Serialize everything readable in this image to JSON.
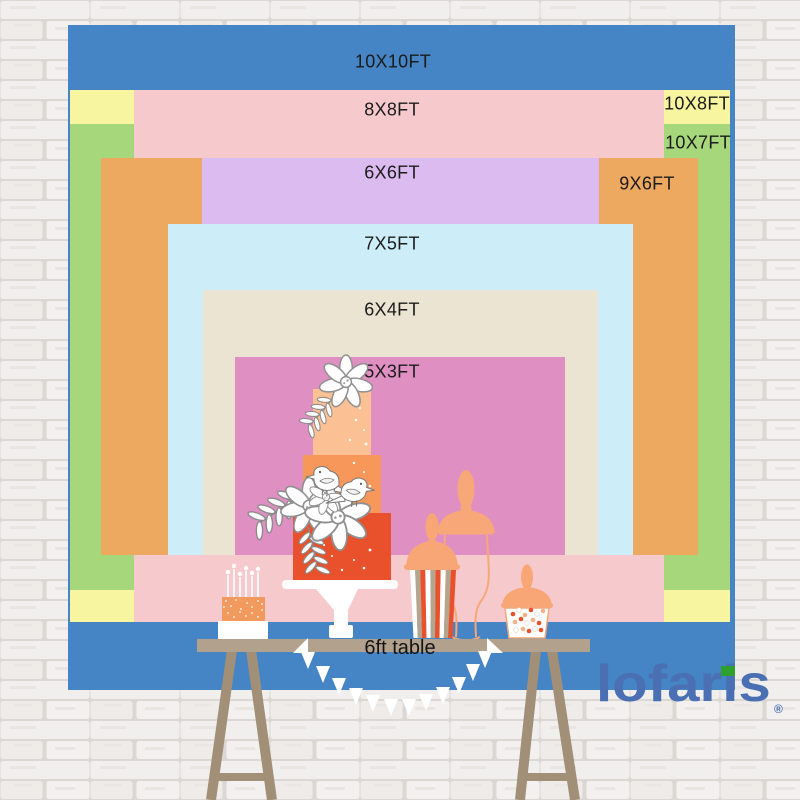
{
  "page": {
    "title": "Backdrop size comparison chart"
  },
  "sizes": [
    {
      "id": "10x10",
      "label": "10X10FT",
      "color": "#4584c5",
      "x": 68,
      "y": 25,
      "w": 667,
      "h": 665,
      "label_x": 393,
      "label_y": 62
    },
    {
      "id": "10x8",
      "label": "10X8FT",
      "color": "#f8f5a1",
      "x": 70,
      "y": 90,
      "w": 660,
      "h": 532,
      "label_x": 697,
      "label_y": 104
    },
    {
      "id": "10x7",
      "label": "10X7FT",
      "color": "#a7d77b",
      "x": 70,
      "y": 124,
      "w": 660,
      "h": 466,
      "label_x": 698,
      "label_y": 143
    },
    {
      "id": "8x8",
      "label": "8X8FT",
      "color": "#f6c9cd",
      "x": 134,
      "y": 90,
      "w": 530,
      "h": 532,
      "label_x": 392,
      "label_y": 110
    },
    {
      "id": "9x6",
      "label": "9X6FT",
      "color": "#eda960",
      "x": 101,
      "y": 158,
      "w": 597,
      "h": 397,
      "label_x": 647,
      "label_y": 184
    },
    {
      "id": "6x6",
      "label": "6X6FT",
      "color": "#dcbcf0",
      "x": 202,
      "y": 158,
      "w": 397,
      "h": 397,
      "label_x": 392,
      "label_y": 173
    },
    {
      "id": "7x5",
      "label": "7X5FT",
      "color": "#cdeef9",
      "x": 168,
      "y": 224,
      "w": 465,
      "h": 331,
      "label_x": 392,
      "label_y": 244
    },
    {
      "id": "6x4",
      "label": "6X4FT",
      "color": "#ece4d2",
      "x": 203,
      "y": 290,
      "w": 395,
      "h": 265,
      "label_x": 392,
      "label_y": 310
    },
    {
      "id": "5x3",
      "label": "5X3FT",
      "color": "#e08fc3",
      "x": 235,
      "y": 357,
      "w": 330,
      "h": 198,
      "label_x": 392,
      "label_y": 372
    }
  ],
  "table": {
    "label": "6ft table"
  },
  "brand": {
    "name": "lofaris",
    "registered": "®",
    "blue": "#4a6fb3",
    "green": "#2ea02f"
  },
  "colors": {
    "wall_brick": "#f1efed",
    "wall_mortar": "#dbd7d3",
    "table_board": "#b2a28d",
    "table_legs": "#a28f77",
    "cake_tier_top": "#fcc095",
    "cake_tier_middle": "#f8975a",
    "cake_tier_bottom": "#e8512b",
    "dessert_peach": "#f9a676",
    "jar_peach": "#f7a778",
    "stripe_taupe": "#b5a48e",
    "label_text": "#1b1b1b"
  }
}
